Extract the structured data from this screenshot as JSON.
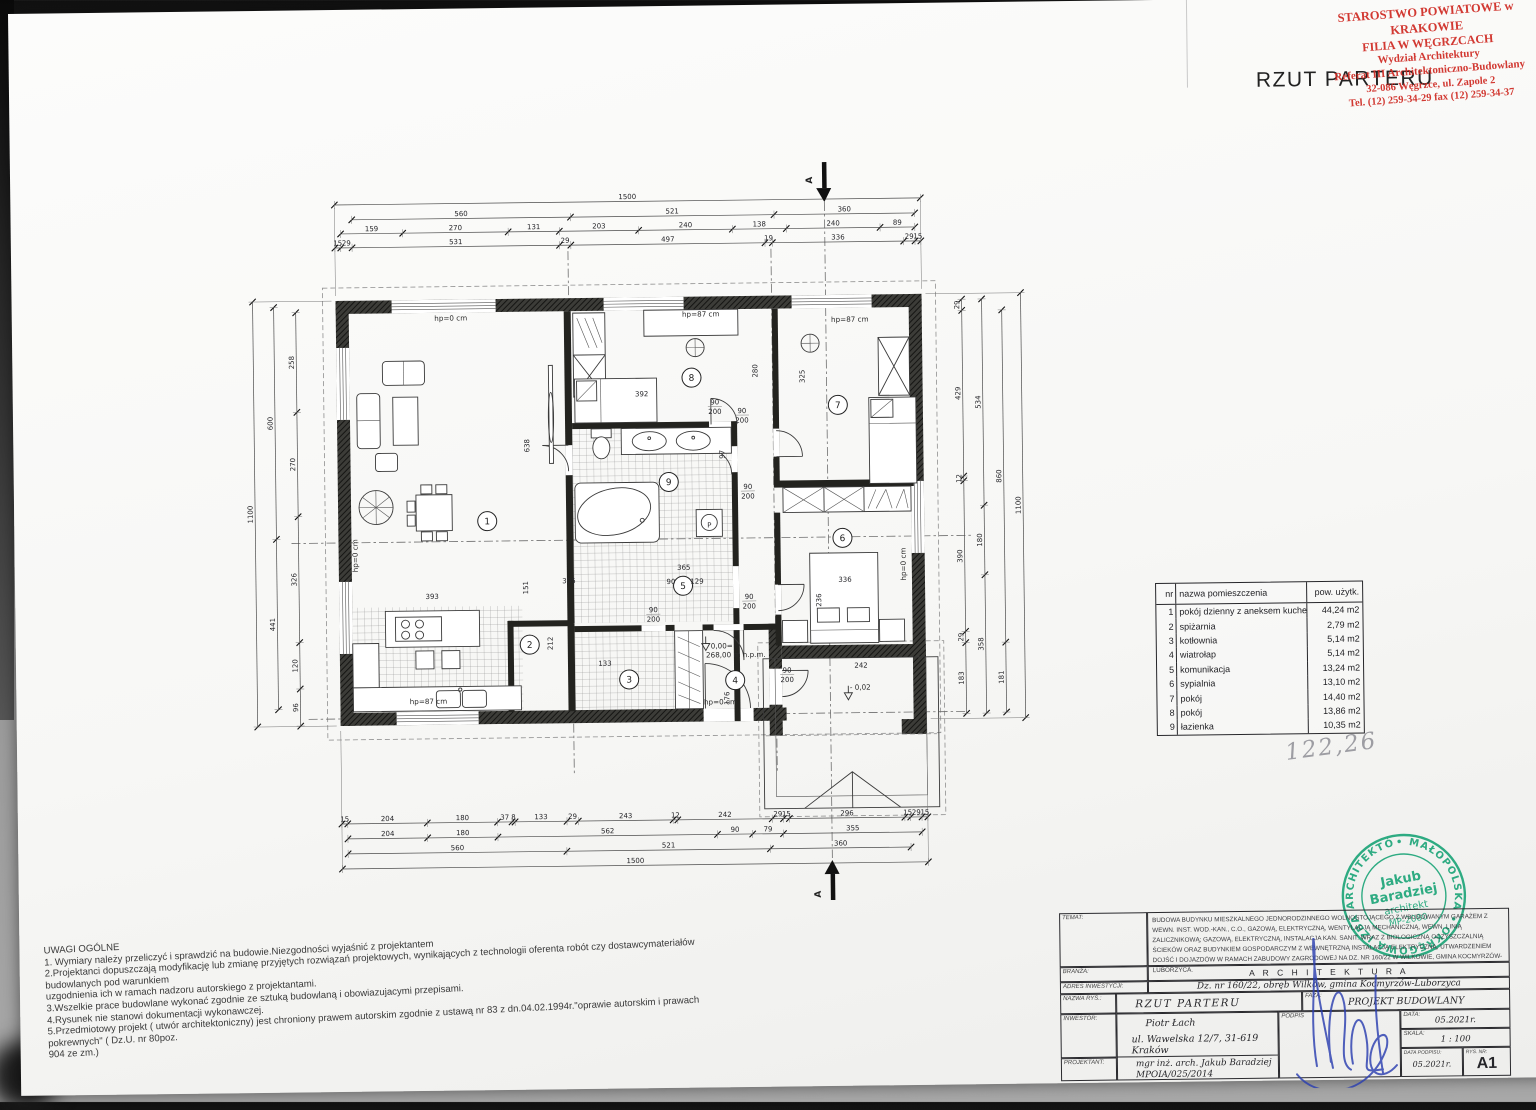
{
  "title": "RZUT PARTERU",
  "handwritten_total": "122,26",
  "red_stamp": {
    "color": "#cf2b24",
    "lines": [
      "STAROSTWO POWIATOWE w KRAKOWIE",
      "FILIA W WĘGRZCACH",
      "Wydział Architektury",
      "Referat III Architektoniczno-Budowlany",
      "32-086 Węgrzce, ul. Zapole 2",
      "Tel. (12) 259-34-29 fax (12) 259-34-37"
    ]
  },
  "green_stamp": {
    "color": "#14a273",
    "ring_text": "• MAŁOPOLSKA •  OKRĘGOWA IZBA ARCHITEKTÓW",
    "center": [
      "Jakub",
      "Baradziej",
      "architekt",
      "MP-2080"
    ]
  },
  "rooms_table": {
    "col_nr": "nr",
    "col_name": "nazwa pomieszczenia",
    "col_area": "pow. użytk.",
    "rows": [
      [
        "1",
        "pokój dzienny z aneksem kuchennym",
        "44,24 m2"
      ],
      [
        "2",
        "spiżarnia",
        "2,79 m2"
      ],
      [
        "3",
        "kotłownia",
        "5,14 m2"
      ],
      [
        "4",
        "wiatrołap",
        "5,14 m2"
      ],
      [
        "5",
        "komunikacja",
        "13,24 m2"
      ],
      [
        "6",
        "sypialnia",
        "13,10 m2"
      ],
      [
        "7",
        "pokój",
        "14,40 m2"
      ],
      [
        "8",
        "pokój",
        "13,86 m2"
      ],
      [
        "9",
        "łazienka",
        "10,35 m2"
      ]
    ]
  },
  "notes": {
    "title": "UWAGI OGÓLNE",
    "lines": [
      "1. Wymiary należy przeliczyć i sprawdzić na budowie.Niezgodności wyjaśnić z   projektantem",
      "2.Projektanci dopuszczają modyfikację lub zmianę przyjętych rozwiązań    projektowych, wynikających z technologii oferenta robót czy dostawcymateriałów budowlanych pod warunkiem",
      "uzgodnienia ich w ramach nadzoru autorskiego z projektantami.",
      "3.Wszelkie prace budowlane wykonać zgodnie ze sztuką budowlaną i obowiazujacymi przepisami.",
      "4.Rysunek nie stanowi dokumentacji wykonawczej.",
      "5.Przedmiotowy projekt  ( utwór architektoniczny)  jest chroniony prawem autorskim zgodnie z ustawą nr 83 z dn.04.02.1994r.\"oprawie autorskim i prawach pokrewnych\" ( Dz.U. nr 80poz.",
      "904 ze zm.)"
    ]
  },
  "title_block": {
    "labels": {
      "temat": "TEMAT:",
      "branza": "BRANŻA:",
      "adres": "ADRES INWESTYCJI:",
      "nazwa": "NAZWA RYS.:",
      "inwestor": "INWESTOR:",
      "projektant": "PROJEKTANT:",
      "faza": "FAZA:",
      "data": "DATA:",
      "skala": "SKALA:",
      "data_podpisu": "DATA PODPISU:",
      "rys_nr": "RYS. NR:",
      "podpis": "PODPIS"
    },
    "temat": "BUDOWA BUDYNKU MIESZKALNEGO JEDNORODZINNEGO WOLNOSTOJĄCEGO Z WBUDOWANYM GARAŻEM Z WEWN. INST. WOD.-KAN., C.O., GAZOWĄ, ELEKTRYCZNĄ, WENTYLACJĄ MECHANICZNĄ, WEWN. LINIĄ ZALICZNIKOWĄ; GAZOWĄ, ELEKTRYCZNĄ, INSTALACJA KAN. SANIT. WRAZ Z BIOLOGICZNĄ OCZYSZCZALNIĄ ŚCIEKÓW ORAZ BUDYNKIEM GOSPODARCZYM Z WEWNĘTRZNĄ INSTALACJĄ ELEKTRYCZNĄ, UTWARDZENIEM DOJŚĆ I DOJAZDÓW W RAMACH ZABUDOWY ZAGRODOWEJ NA DZ. NR 160/22 W WILKOWIE, GMINA KOCMYRZÓW-LUBORZYCA.",
    "branza": "A R C H I T E K T U R A",
    "adres": "Dz. nr 160/22, obręb  Wilków, gmina Kocmyrzów-Luborzyca",
    "nazwa": "RZUT PARTERU",
    "inwestor_1": "Piotr Łach",
    "inwestor_2": "ul. Wawelska 12/7, 31-619 Kraków",
    "projektant_1": "mgr inż. arch. Jakub Baradziej",
    "projektant_2": "MPOIA/025/2014",
    "faza": "PROJEKT BUDOWLANY",
    "data": "05.2021r.",
    "skala": "1 : 100",
    "data_podpisu": "05.2021r.",
    "rys_nr": "A1"
  },
  "plan": {
    "section_label": "A",
    "door_w": "90",
    "door_h": "200",
    "dim_chains_h": [
      {
        "y": 209,
        "vals": [
          1500
        ]
      },
      {
        "y": 224,
        "pre": 44,
        "post": 15,
        "vals": [
          560,
          521,
          360
        ]
      },
      {
        "y": 238,
        "pre": 15,
        "post": 15,
        "vals": [
          159,
          270,
          131,
          203,
          240,
          138,
          240,
          89
        ]
      },
      {
        "y": 252,
        "vals": [
          15,
          29,
          531,
          29,
          497,
          19,
          336,
          29,
          15
        ]
      },
      {
        "y": 828,
        "vals": [
          15,
          204,
          180,
          37,
          8,
          133,
          29,
          243,
          12,
          242,
          29,
          15,
          296,
          15,
          29,
          15
        ]
      },
      {
        "y": 843,
        "pre": 15,
        "post": 15,
        "vals": [
          204,
          180,
          562,
          90,
          79,
          355
        ]
      },
      {
        "y": 858,
        "pre": 15,
        "post": 44,
        "vals": [
          560,
          521,
          360
        ]
      },
      {
        "y": 873,
        "vals": [
          1500
        ]
      }
    ],
    "dim_chains_v": [
      {
        "x": 292,
        "pre": 29,
        "post": 1,
        "vals": [
          258,
          270,
          326,
          120,
          96
        ]
      },
      {
        "x": 270,
        "pre": 15,
        "post": 44,
        "vals": [
          600,
          441
        ]
      },
      {
        "x": 249,
        "vals": [
          1100
        ]
      },
      {
        "x": 958,
        "pre": 15,
        "post": 13,
        "vals": [
          29,
          429,
          12,
          390,
          29,
          183
        ]
      },
      {
        "x": 978,
        "pre": 15,
        "post": 13,
        "vals": [
          534,
          180,
          358
        ]
      },
      {
        "x": 998,
        "pre": 44,
        "post": 15,
        "vals": [
          860,
          181
        ]
      },
      {
        "x": 1017,
        "vals": [
          1100
        ]
      }
    ],
    "room_circles": [
      {
        "n": "1",
        "x": 481,
        "y": 527
      },
      {
        "n": "2",
        "x": 522,
        "y": 651
      },
      {
        "n": "3",
        "x": 621,
        "y": 687
      },
      {
        "n": "4",
        "x": 727,
        "y": 689
      },
      {
        "n": "5",
        "x": 676,
        "y": 594
      },
      {
        "n": "6",
        "x": 836,
        "y": 548
      },
      {
        "n": "7",
        "x": 833,
        "y": 415
      },
      {
        "n": "8",
        "x": 687,
        "y": 386
      },
      {
        "n": "9",
        "x": 663,
        "y": 490
      }
    ],
    "window_labels": [
      {
        "t": "hp=0 cm",
        "x": 447,
        "y": 326
      },
      {
        "t": "hp=87 cm",
        "x": 697,
        "y": 325
      },
      {
        "t": "hp=87 cm",
        "x": 846,
        "y": 332
      },
      {
        "t": "hp=0 cm",
        "x": 351,
        "y": 560,
        "r": 1
      },
      {
        "t": "hp=87 cm",
        "x": 420,
        "y": 709
      },
      {
        "t": "hp=0 cm",
        "x": 712,
        "y": 713
      },
      {
        "t": "hp=0 cm",
        "x": 899,
        "y": 575,
        "r": 1
      }
    ],
    "door_labels": [
      {
        "x": 737,
        "y": 422
      },
      {
        "x": 742,
        "y": 498
      },
      {
        "x": 742,
        "y": 608
      },
      {
        "x": 779,
        "y": 682
      },
      {
        "x": 646,
        "y": 620
      },
      {
        "x": 710,
        "y": 413
      }
    ],
    "levels": {
      "zero_1": "0,00=",
      "zero_2": "268,00 m n.p.m.",
      "minus": "- 0,02"
    },
    "interior_dims": [
      {
        "t": "392",
        "x": 637,
        "y": 404
      },
      {
        "t": "638",
        "x": 524,
        "y": 452,
        "r": 1
      },
      {
        "t": "393",
        "x": 425,
        "y": 604
      },
      {
        "t": "151",
        "x": 521,
        "y": 594,
        "r": 1
      },
      {
        "t": "305",
        "x": 562,
        "y": 590
      },
      {
        "t": "365",
        "x": 677,
        "y": 578
      },
      {
        "t": "90",
        "x": 664,
        "y": 592
      },
      {
        "t": "129",
        "x": 690,
        "y": 592
      },
      {
        "t": "212",
        "x": 545,
        "y": 650,
        "r": 1
      },
      {
        "t": "133",
        "x": 597,
        "y": 673
      },
      {
        "t": "336",
        "x": 838,
        "y": 592
      },
      {
        "t": "236",
        "x": 814,
        "y": 610,
        "r": 1
      },
      {
        "t": "242",
        "x": 853,
        "y": 678
      },
      {
        "t": "325",
        "x": 800,
        "y": 386,
        "r": 1
      },
      {
        "t": "280",
        "x": 753,
        "y": 380,
        "r": 1
      },
      {
        "t": "97",
        "x": 719,
        "y": 463,
        "r": 1
      },
      {
        "t": "176",
        "x": 721,
        "y": 707,
        "r": 1
      }
    ],
    "misc_labels": [
      {
        "t": "P",
        "x": 703,
        "y": 536
      }
    ]
  }
}
